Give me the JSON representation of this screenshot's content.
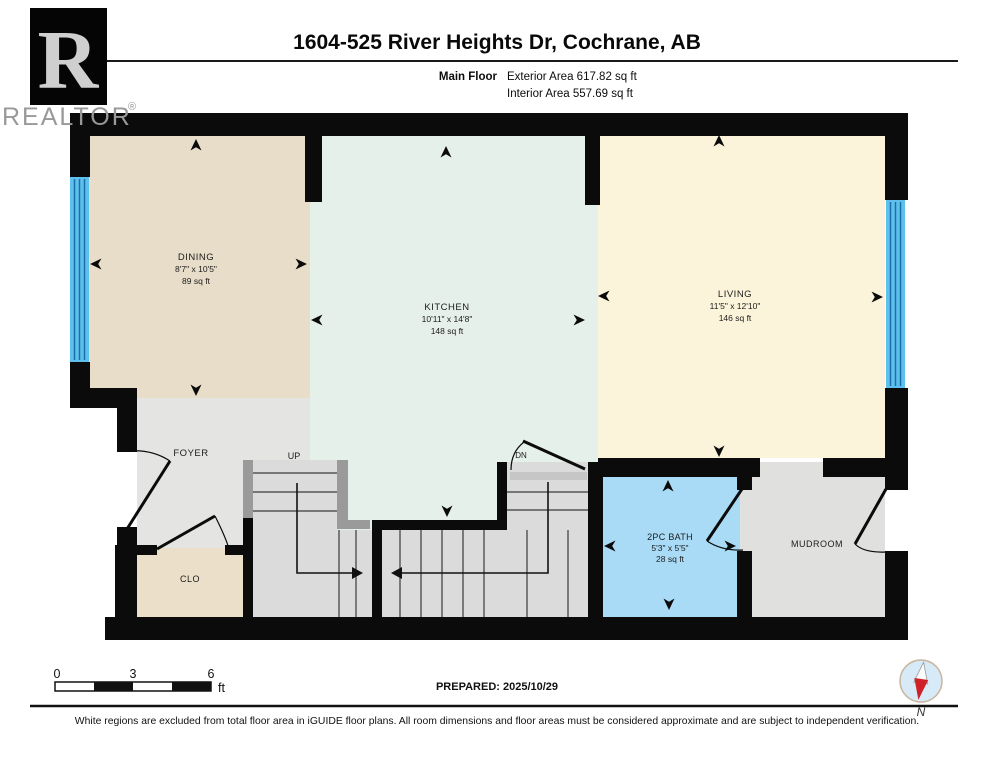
{
  "header": {
    "logo_letter": "R",
    "brand": "REALTOR",
    "reg": "®",
    "title": "1604-525 River Heights Dr, Cochrane, AB",
    "floor_label": "Main Floor",
    "exterior_area": "Exterior Area 617.82 sq ft",
    "interior_area": "Interior Area 557.69 sq ft"
  },
  "rooms": {
    "dining": {
      "name": "DINING",
      "dims": "8'7\" x 10'5\"",
      "area": "89 sq ft"
    },
    "kitchen": {
      "name": "KITCHEN",
      "dims": "10'11\" x 14'8\"",
      "area": "148 sq ft"
    },
    "living": {
      "name": "LIVING",
      "dims": "11'5\" x 12'10\"",
      "area": "146 sq ft"
    },
    "bath": {
      "name": "2PC BATH",
      "dims": "5'3\" x 5'5\"",
      "area": "28 sq ft"
    },
    "foyer": {
      "name": "FOYER"
    },
    "closet": {
      "name": "CLO"
    },
    "mudroom": {
      "name": "MUDROOM"
    },
    "stairs_up": {
      "label": "UP"
    },
    "stairs_dn": {
      "label": "DN"
    }
  },
  "footer": {
    "scale": {
      "tick0": "0",
      "tick1": "3",
      "tick2": "6",
      "unit": "ft"
    },
    "prepared": "PREPARED: 2025/10/29",
    "compass_label": "N",
    "disclaimer": "White regions are excluded from total floor area in iGUIDE floor plans. All room dimensions and floor areas must be considered approximate and are subject to independent verification."
  },
  "colors": {
    "wall": "#0b0b0b",
    "dining": "#e8ddc8",
    "kitchen": "#e6f0ea",
    "living": "#fbf4da",
    "bath": "#a9dbf6",
    "gray_room": "#e4e4e2",
    "stairs": "#dbdbdb",
    "closet": "#ecdfc9",
    "window": "#5ec1ed",
    "window_line": "#1c6fa8",
    "rail": "#9a9a9a",
    "compass_red": "#cf2128",
    "compass_fill": "#d6eaf7"
  }
}
